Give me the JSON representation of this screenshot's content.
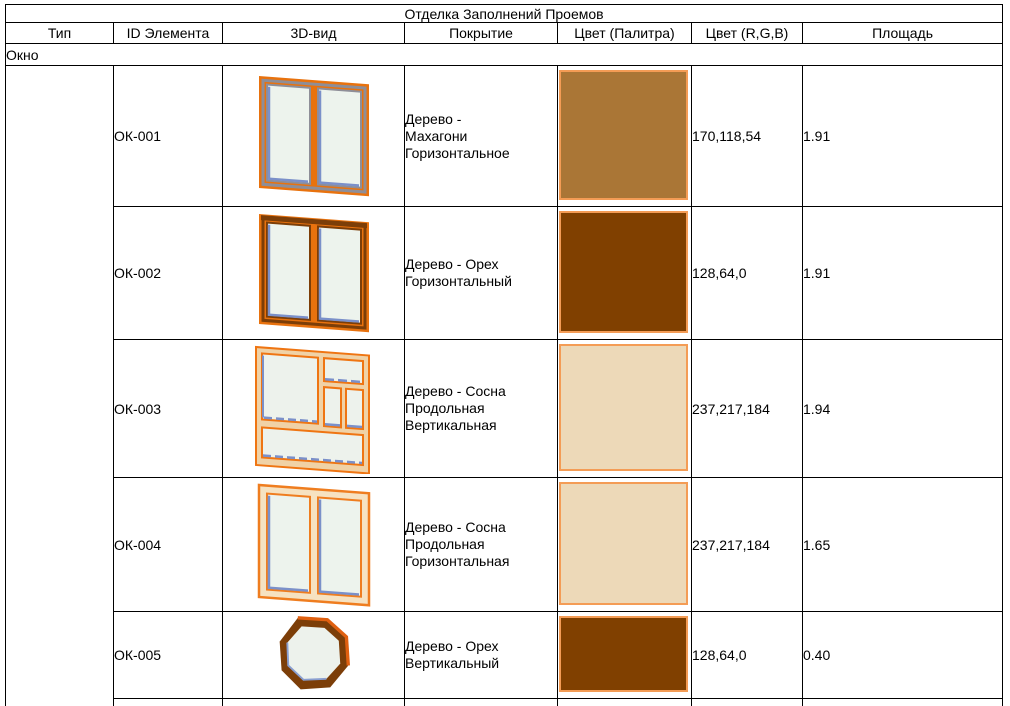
{
  "table": {
    "title": "Отделка Заполнений Проемов",
    "columns": [
      "Тип",
      "ID Элемента",
      "3D-вид",
      "Покрытие",
      "Цвет  (Палитра)",
      "Цвет (R,G,B)",
      "Площадь"
    ],
    "group_row_label": "Окно",
    "rows": [
      {
        "id": "ОК-001",
        "view_icon": "window-two-pane-mahogany",
        "coating": "Дерево -\nМахагони\nГоризонтальное",
        "palette_hex": "#AA7636",
        "rgb": "170,118,54",
        "area": "1.91"
      },
      {
        "id": "ОК-002",
        "view_icon": "window-two-pane-walnut",
        "coating": "Дерево - Орех\nГоризонтальный",
        "palette_hex": "#804000",
        "rgb": "128,64,0",
        "area": "1.91"
      },
      {
        "id": "ОК-003",
        "view_icon": "window-multi-pane-pine",
        "coating": "Дерево - Сосна\nПродольная\nВертикальная",
        "palette_hex": "#EDD9B8",
        "rgb": "237,217,184",
        "area": "1.94"
      },
      {
        "id": "ОК-004",
        "view_icon": "window-two-pane-pine",
        "coating": "Дерево - Сосна\nПродольная\nГоризонтальная",
        "palette_hex": "#EDD9B8",
        "rgb": "237,217,184",
        "area": "1.65"
      },
      {
        "id": "ОК-005",
        "view_icon": "window-octagon-walnut",
        "coating": "Дерево - Орех\nВертикальный",
        "palette_hex": "#804000",
        "rgb": "128,64,0",
        "area": "0.40"
      }
    ],
    "colors": {
      "grid": "#000000",
      "swatch_border": "#F49C55",
      "frame_orange": "#E8720E",
      "frame_walnut": "#7C3E08",
      "frame_pine_tan": "#F0D2A6",
      "frame_pine_cream": "#F6E2C1",
      "glass": "#EDF3ED",
      "glass_accent_blue": "#7B90C9"
    }
  }
}
